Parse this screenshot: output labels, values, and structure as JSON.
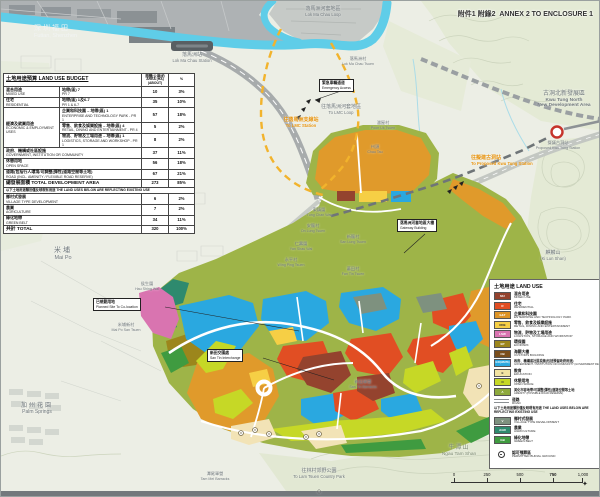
{
  "header": {
    "annex_zh": "附件1 附錄2",
    "annex_en": "ANNEX 2 TO ENCLOSURE 1"
  },
  "table": {
    "title": "土地用途預算 LAND USE BUDGET",
    "col_area_zh": "面積(公頃)約",
    "col_area_en": "AREA (HA)(ABOUT)",
    "col_pct": "%",
    "rows": [
      {
        "zh": "混合用途",
        "en": "MIXED USE",
        "zone_zh": "地帶(區) 7",
        "zone_en": "PR 7",
        "area": "10",
        "pct": "3%"
      },
      {
        "zh": "住宅",
        "en": "RESIDENTIAL",
        "zone_zh": "地帶(區) 1及6-7",
        "zone_en": "PR 1 & 6-7",
        "area": "35",
        "pct": "10%"
      }
    ],
    "econ": {
      "zh": "經濟及就業用途",
      "en": "ECONOMIC & EMPLOYMENT USES",
      "subs": [
        {
          "zh": "企業和科技園 – 地帶(區) 1",
          "en": "ENTERPRISE AND TECHNOLOGY PARK - PR 1",
          "area": "57",
          "pct": "18%"
        },
        {
          "zh": "零售、飲食及娛樂設施 – 地帶(區) 4",
          "en": "RETAIL, DINING AND ENTERTAINMENT - PR 4",
          "area": "5",
          "pct": "2%"
        },
        {
          "zh": "物流、貯物及工場用途 – 地帶(區) 1",
          "en": "LOGISTICS, STORAGE AND WORKSHOP - PR 1",
          "area": "8",
          "pct": "2%"
        }
      ]
    },
    "rows2": [
      {
        "zh": "政府、機構或社區設施",
        "en": "GOVERNMENT, INSTITUTION OR COMMUNITY",
        "area": "37",
        "pct": "11%"
      },
      {
        "zh": "休憩用地",
        "en": "OPEN SPACE",
        "area": "56",
        "pct": "18%"
      },
      {
        "zh": "道路(包括行人環境/可調整(彈性)道路空間等土地)",
        "en": "ROAD (INCL. AMENITY / FLEXIBLE ROAD RESERVE)",
        "area": "67",
        "pct": "21%"
      }
    ],
    "total_dev": {
      "zh": "總發展面積 TOTAL DEVELOPMENT AREA",
      "area": "273",
      "pct": "85%"
    },
    "note": "以下土地用途類別僅反映現有用途 THE LAND USES BELOW ARE REFLECTING EXISTING USE",
    "rows3": [
      {
        "zh": "鄉村式發展",
        "en": "VILLAGE TYPE DEVELOPMENT",
        "area": "6",
        "pct": "2%"
      },
      {
        "zh": "農業",
        "en": "AGRICULTURE",
        "area": "7",
        "pct": "2%"
      },
      {
        "zh": "綠化地帶",
        "en": "GREEN BELT",
        "area": "34",
        "pct": "11%"
      }
    ],
    "total": {
      "zh": "共計 TOTAL",
      "area": "320",
      "pct": "100%"
    }
  },
  "legend": {
    "title": "土地用途 LAND USE",
    "items": [
      {
        "code": "MU",
        "color": "#94432e",
        "zh": "混合用途",
        "en": "MIXED USE"
      },
      {
        "code": "R",
        "color": "#e14e23",
        "zh": "住宅",
        "en": "RESIDENTIAL"
      },
      {
        "code": "E&T",
        "color": "#dd9426",
        "zh": "企業和科技園",
        "en": "ENTERPRISE AND TECHNOLOGY PARK"
      },
      {
        "code": "RDE",
        "color": "#f6cf45",
        "zh": "零售、飲食及娛樂設施",
        "en": "RETAIL, DINING AND ENTERTAINMENT"
      },
      {
        "code": "LSW",
        "color": "#d974b0",
        "zh": "物流、貯物及工場用途",
        "en": "LOGISTICS, STORAGE AND WORKSHOP"
      },
      {
        "code": "EP",
        "color": "#9c861c",
        "zh": "環保園",
        "en": "ECOPARK"
      },
      {
        "code": "CB",
        "color": "#7a4e1c",
        "zh": "海關大樓",
        "en": "CUSTOMS BUILDING"
      },
      {
        "code": "G/IC(WHITE)",
        "color": "#2aa8e0",
        "zh": "政府、機構或社區設施(包括預留政府用途)",
        "en": "GOVERNMENT / INSTITUTION OR COMMUNITY (GOVERNMENT RESERVE)"
      },
      {
        "code": "E",
        "color": "#f2e3a2",
        "zh": "教育",
        "en": "EDUCATION"
      },
      {
        "code": "O",
        "color": "#c6d826",
        "zh": "休憩用地",
        "en": "OPEN SPACE"
      },
      {
        "code": "A",
        "color": "#8da93c",
        "zh": "美化市容地帶/可調整(彈性)道路空間等土地",
        "en": "AMENITY (POSSIBLE ROAD RESERVE)"
      }
    ],
    "road": {
      "zh": "道路",
      "en": "ROAD"
    },
    "note": "以下土地用途類別僅反映現有用途 THE LAND USES BELOW ARE REFLECTING EXISTING USE",
    "existing": [
      {
        "code": "V",
        "color": "#7e917f",
        "zh": "鄉村式發展",
        "en": "VILLAGE TYPE DEVELOPMENT"
      },
      {
        "code": "AGR",
        "color": "#2e8a6e",
        "zh": "農業",
        "en": "AGRICULTURE"
      },
      {
        "code": "GB",
        "color": "#3f9b40",
        "zh": "綠化地帶",
        "en": "GREEN BELT"
      }
    ],
    "burial": {
      "zh": "認可殯葬區",
      "en": "PERMITTED BURIAL GROUND"
    }
  },
  "labels": {
    "futian": {
      "zh": "深圳福田",
      "en": "Futian, Shenzhen"
    },
    "lmc_loop": {
      "zh": "落馬洲河套地區",
      "en": "Lok Ma Chau Loop"
    },
    "lmc_station": {
      "zh": "落馬洲站",
      "en": "Lok Ma Chau Station"
    },
    "lmc_tsuen": {
      "zh": "落馬洲村",
      "en": "Lok Ma Chau Tsuen"
    },
    "poon_uk": {
      "zh": "潘屋村",
      "en": "Poon Uk Tsuen"
    },
    "to_lmc_station": {
      "zh": "往落馬洲支線站",
      "en": "To LMC Station"
    },
    "to_lmc_loop": {
      "zh": "往落馬洲河套地區",
      "en": "To LMC Loop"
    },
    "ktn": {
      "zh": "古洞北新發展區",
      "en1": "Kwu Tung North",
      "en2": "New Development Area"
    },
    "proposed_kt_station": {
      "zh": "擬議古洞站",
      "en": "Proposed Kwu Tung Station"
    },
    "to_proposed_kt": {
      "zh": "往擬建古洞站",
      "en": "To Proposed Kwu Tung Station"
    },
    "ki_lun_shan": {
      "zh": "麒麟山",
      "en": "(Ki Lun Shan)"
    },
    "mai_po": {
      "zh": "米埔",
      "en": "Mai Po"
    },
    "hau_shing_wai": {
      "zh": "侯生圍",
      "en": "Hau Shing Wai"
    },
    "mai_po_san_tsuen": {
      "zh": "米埔新村",
      "en": "Mai Po San Tsuen"
    },
    "palm_springs": {
      "zh": "加州花園",
      "en": "Palm Springs"
    },
    "ngau_tam_shan": {
      "zh": "牛潭山",
      "en": "Ngau Tam Shan"
    },
    "tam_mei_barracks": {
      "zh": "潭尾軍營",
      "en": "Tam Mei Barracks"
    },
    "lam_tsuen": {
      "zh": "往林村郊野公園",
      "en": "To Lam Tsuen Country Park"
    },
    "san_tin_barracks": {
      "zh": "新田軍營",
      "en": "San Tin Barracks"
    },
    "villages": [
      {
        "zh": "東鎮圍",
        "en": "Tung Chan Wai"
      },
      {
        "zh": "安龍村",
        "en": "On Lung Tsuen"
      },
      {
        "zh": "新龍村",
        "en": "San Lung Tsuen"
      },
      {
        "zh": "仁壽圍",
        "en": "Yan Shau Wai"
      },
      {
        "zh": "永平村",
        "en": "Wing Ping Tsuen"
      },
      {
        "zh": "蕃田村",
        "en": "Fan Tin Tsuen"
      },
      {
        "zh": "州頭",
        "en": "Chau Tau"
      }
    ]
  },
  "annotations": {
    "spur": {
      "zh": "緊急車輛通道",
      "en": "Emergency Access"
    },
    "planned": {
      "zh": "已規劃用地",
      "en": "Planned Site To Co-location"
    },
    "interchange": {
      "zh": "新田交匯處",
      "en": "San Tin Interchange"
    },
    "gateway": {
      "zh": "落馬洲河套地區大樓",
      "en": "Gateway Building"
    }
  },
  "scalebar": {
    "t0": "0",
    "t1": "250",
    "t2": "500",
    "t3": "750",
    "t4": "1,000",
    "unit": "Meters"
  }
}
